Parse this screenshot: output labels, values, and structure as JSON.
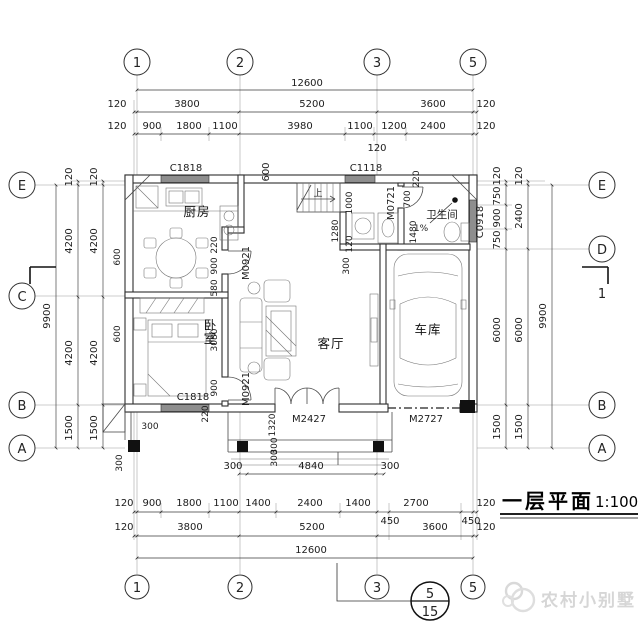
{
  "title_block": {
    "title": "一层平面",
    "scale": "1:100"
  },
  "watermark": {
    "text": "农村小别墅"
  },
  "rooms": {
    "kitchen": "厨房",
    "bedroom": "卧室",
    "living": "客厅",
    "garage": "车库",
    "bathroom": "卫生间",
    "slope": "1%",
    "up": "上"
  },
  "openings": {
    "win_kitchen": "C1818",
    "win_stair": "C1118",
    "win_bed": "C1818",
    "win_bath": "C0918",
    "door_dining": "M0921",
    "door_bed": "M0921",
    "door_bath": "M0721",
    "door_main": "M2427",
    "door_garage": "M2727"
  },
  "axes": {
    "t": [
      "1",
      "2",
      "3",
      "5"
    ],
    "b": [
      "1",
      "2",
      "3",
      "5"
    ],
    "l": [
      "E",
      "C",
      "B",
      "A"
    ],
    "r": [
      "E",
      "D",
      "B",
      "A"
    ]
  },
  "callout": {
    "top": "5",
    "bottom": "15"
  },
  "section_label": "1",
  "dims": {
    "t1": [
      "12600"
    ],
    "t2": [
      "120",
      "3800",
      "5200",
      "3600",
      "120"
    ],
    "t3": [
      "120",
      "900",
      "1800",
      "1100",
      "3980",
      "1100",
      "1200",
      "2400",
      "120"
    ],
    "t4": [
      "120"
    ],
    "wt": [
      "600",
      "220"
    ],
    "lo": [
      "120",
      "4200",
      "4200",
      "1500"
    ],
    "li": [
      "120",
      "4200",
      "4200",
      "1500"
    ],
    "lt": [
      "9900"
    ],
    "lw": [
      "600",
      "600"
    ],
    "ri": [
      "120",
      "750",
      "900",
      "750",
      "6000",
      "1500"
    ],
    "rm": [
      "120",
      "2400",
      "6000",
      "1500"
    ],
    "rt": [
      "9900"
    ],
    "b1": [
      "120",
      "900",
      "1800",
      "1100",
      "1400",
      "2400",
      "1400",
      "2700",
      "120"
    ],
    "b1x": [
      "450",
      "450"
    ],
    "b2": [
      "120",
      "3800",
      "5200",
      "3600",
      "120"
    ],
    "b3": [
      "12600"
    ],
    "pr": [
      "300",
      "4840",
      "300"
    ],
    "ms": [
      "300",
      "300",
      "1320",
      "300",
      "300",
      "220"
    ],
    "in": [
      "220",
      "900",
      "580",
      "3080",
      "900",
      "1000",
      "1280",
      "120",
      "300",
      "700",
      "1480"
    ]
  },
  "colors": {
    "line": "#2f2f2f",
    "window_fill": "#8e8e8e",
    "watermark": "#d6d6d6",
    "paper": "#ffffff"
  }
}
